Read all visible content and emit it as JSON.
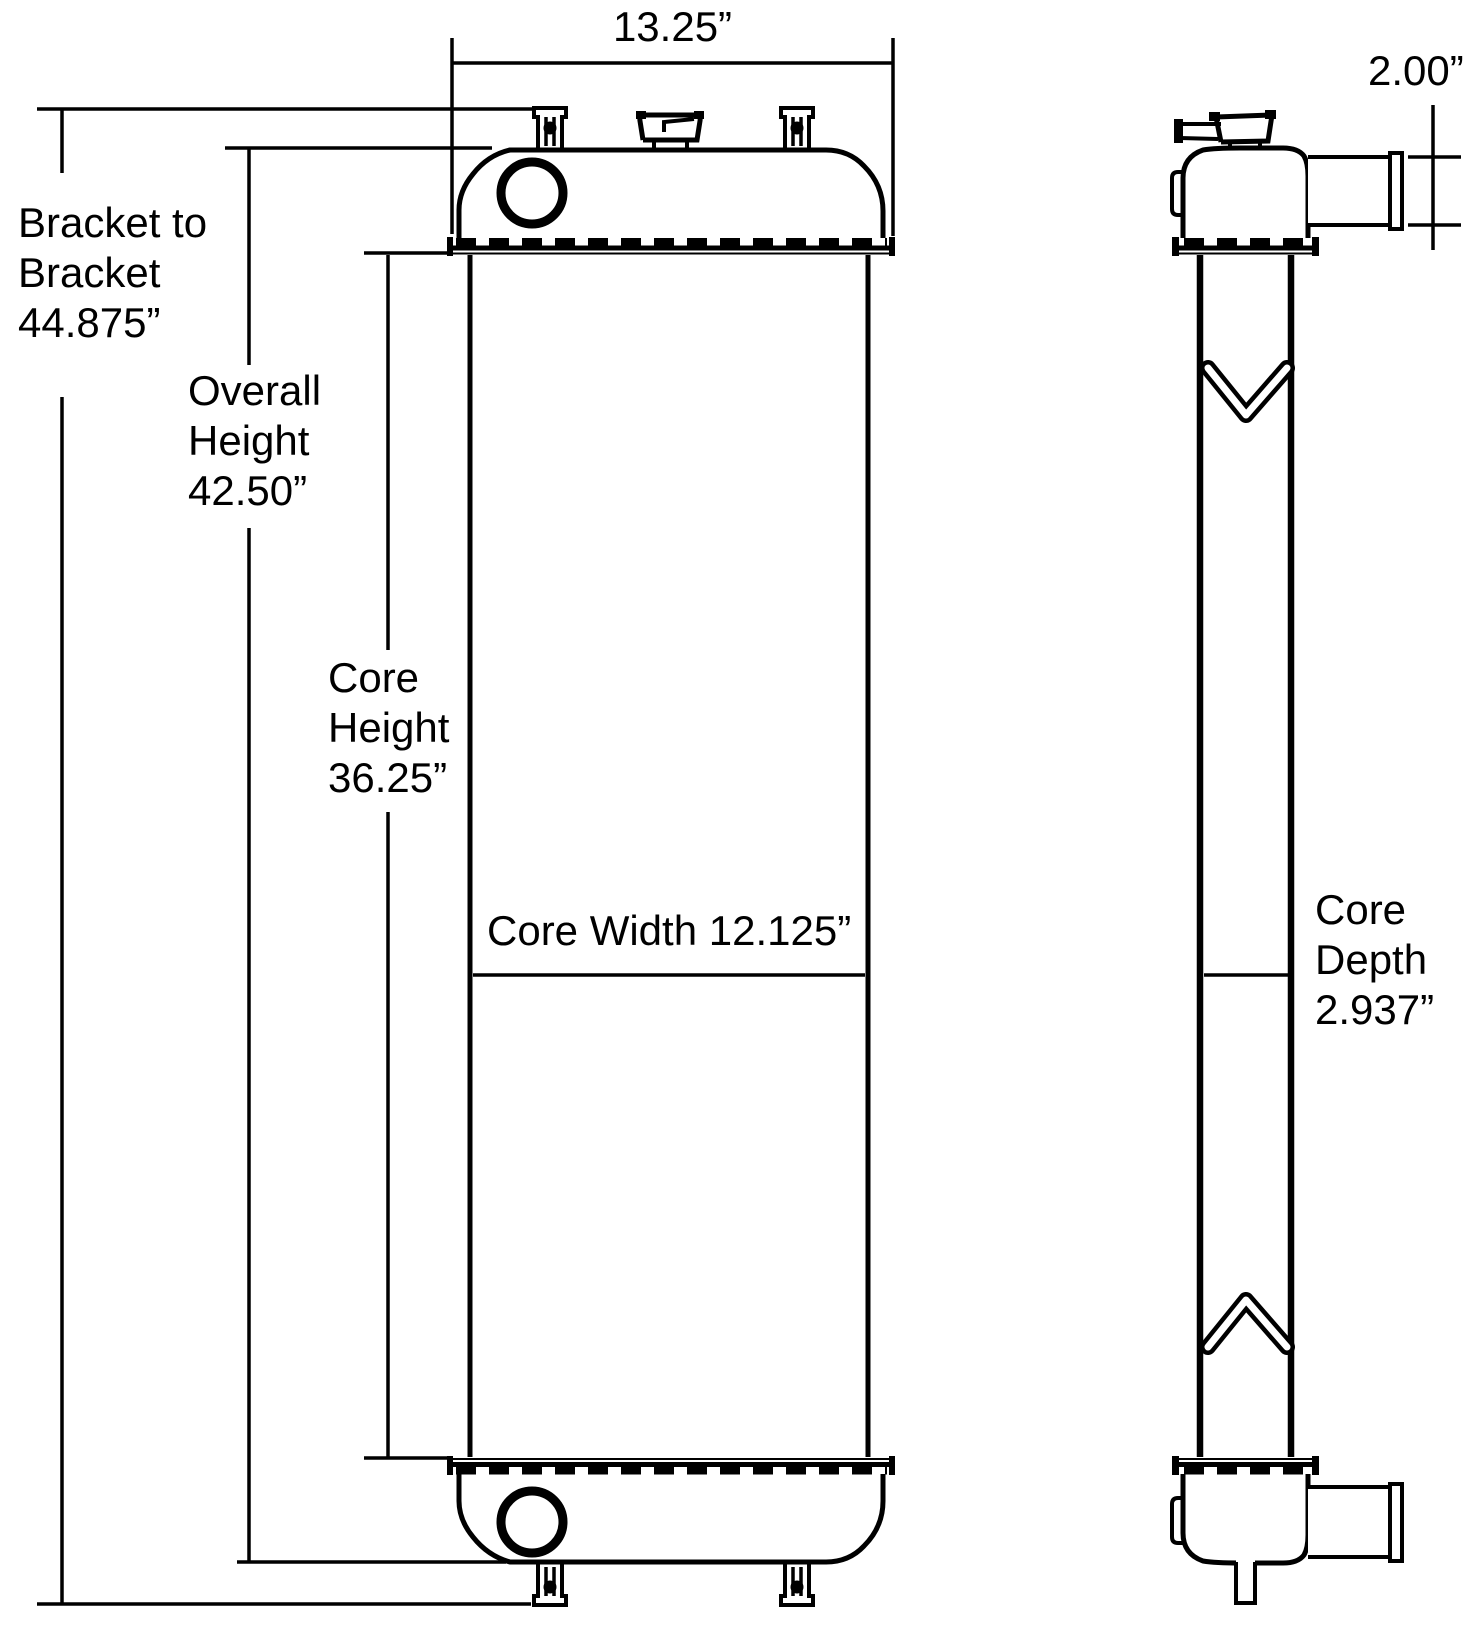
{
  "drawing": {
    "type": "radiator-dimensional-drawing",
    "colors": {
      "ink": "#000000",
      "paper": "#ffffff"
    },
    "front_view": {
      "top_width": "13.25”",
      "bracket_to_bracket": {
        "l1": "Bracket to",
        "l2": "Bracket",
        "l3": "44.875”"
      },
      "overall_height": {
        "l1": "Overall",
        "l2": "Height",
        "l3": "42.50”"
      },
      "core_height": {
        "l1": "Core",
        "l2": "Height",
        "l3": "36.25”"
      },
      "core_width": "Core Width 12.125”"
    },
    "side_view": {
      "port_diameter": "2.00”",
      "core_depth": {
        "l1": "Core",
        "l2": "Depth",
        "l3": "2.937”"
      }
    }
  }
}
